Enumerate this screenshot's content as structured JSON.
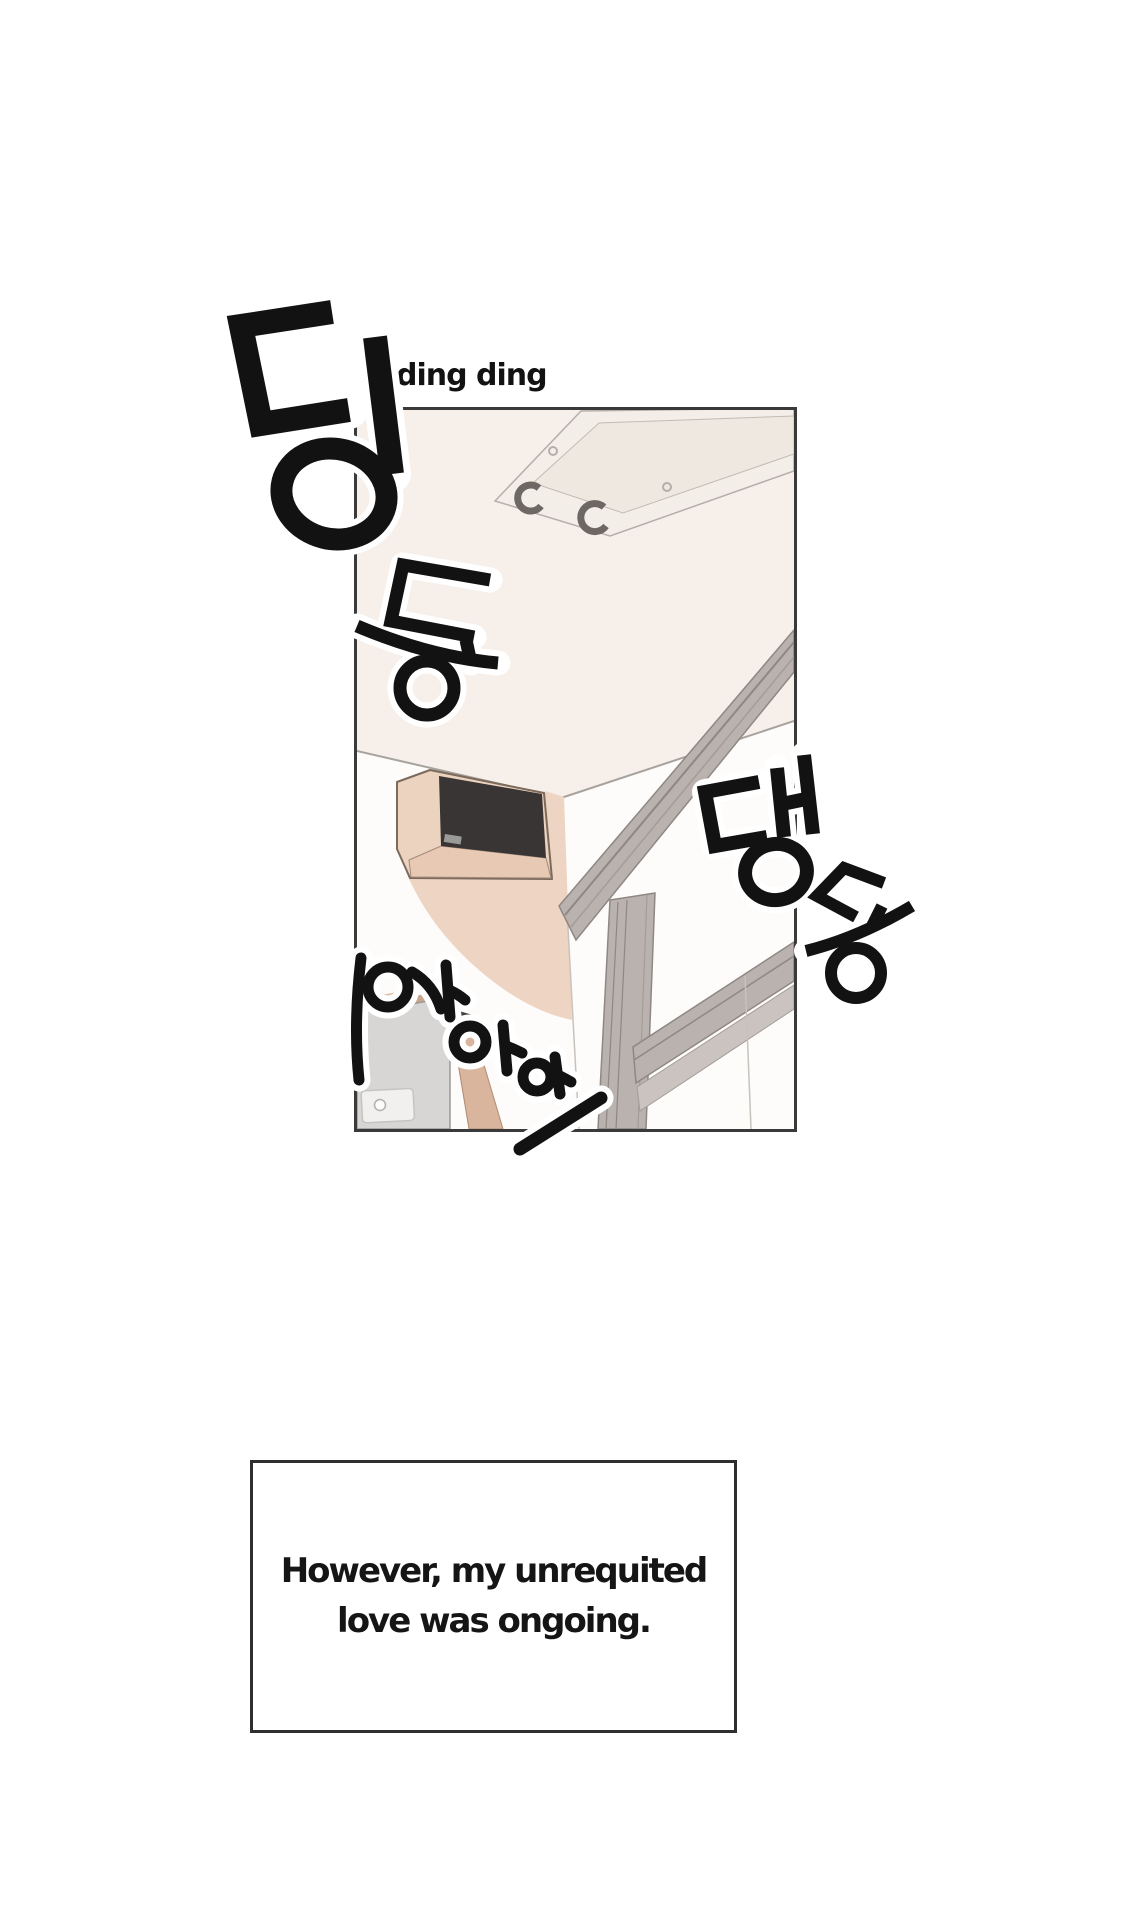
{
  "page": {
    "width": 1144,
    "height": 1916,
    "background": "#ffffff"
  },
  "sfx": {
    "ding_ding": "ding ding",
    "hangul": [
      {
        "char": "딩",
        "romanized": "ding"
      },
      {
        "char": "동",
        "romanized": "dong"
      },
      {
        "char": "댕",
        "romanized": "daeng"
      },
      {
        "char": "동",
        "romanized": "dong"
      },
      {
        "char": "와아아",
        "romanized": "waaah"
      }
    ]
  },
  "caption": {
    "line1": "However, my unrequited",
    "line2": "love was ongoing."
  },
  "colors": {
    "page_bg": "#ffffff",
    "ink": "#121212",
    "halo": "#ffffff",
    "panel_border": "#3a3a3a",
    "caption_border": "#2e2e2e",
    "ceiling": "#f7f0ea",
    "wall": "#fdfcfa",
    "edge_line": "#a8a29d",
    "fixture_fill": "#f4eee8",
    "fixture_inner": "#efe8e1",
    "fixture_line": "#b5aeaa",
    "clip_gray": "#6e6864",
    "shadow_peach": "#eed4c2",
    "speaker_box_tan": "#ecd3bf",
    "speaker_bottom_tan": "#e7c9b4",
    "speaker_face_dark": "#393534",
    "speaker_outline": "#7c6a5c",
    "board_gray": "#d7d6d4",
    "board_tan_bar": "#c9a58d",
    "board_tan_bar_light": "#e2c3ab",
    "paper_fill": "#f1f0ee",
    "wedge_dark": "#45403d",
    "tan_strip": "#d9b59e",
    "frame_gray": "#b9b2ae",
    "frame_line": "#8e8783",
    "frame_light": "#cac3bf",
    "jamb_line": "#c8c2bd"
  }
}
